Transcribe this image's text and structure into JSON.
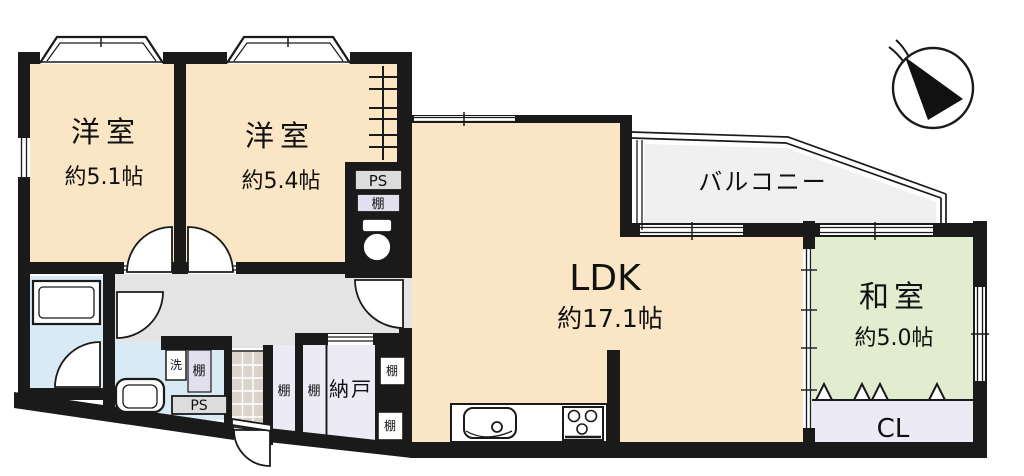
{
  "rooms": {
    "bedroom1": {
      "name": "洋室",
      "size": "約5.1帖"
    },
    "bedroom2": {
      "name": "洋室",
      "size": "約5.4帖"
    },
    "ldk": {
      "name": "LDK",
      "size": "約17.1帖"
    },
    "washitsu": {
      "name": "和室",
      "size": "約5.0帖"
    },
    "balcony": {
      "name": "バルコニー"
    },
    "nando": {
      "name": "納戸"
    },
    "closet": {
      "name": "CL"
    }
  },
  "fixtures": {
    "ps_shaft": "PS",
    "ps_laundry": "PS",
    "shelf_toilet_col": "棚",
    "shelf_laundry": "棚",
    "shelf_hall_left": "棚",
    "shelf_hall_right": "棚",
    "shelf_niche_top": "棚",
    "shelf_niche_bottom": "棚",
    "laundry": "洗"
  },
  "colors": {
    "room_floor": "#FAE6C5",
    "hallway": "#E4E4E4",
    "balcony": "#F0F0F0",
    "tatami": "#E2ECCF",
    "wet_area": "#D8EBF4",
    "storage": "#ECEAF4",
    "shelf_gray": "#DCDCDC",
    "shelf_lavender": "#E2DFEE",
    "wall": "#1A1A1A",
    "tile": "#D9D4C9"
  }
}
